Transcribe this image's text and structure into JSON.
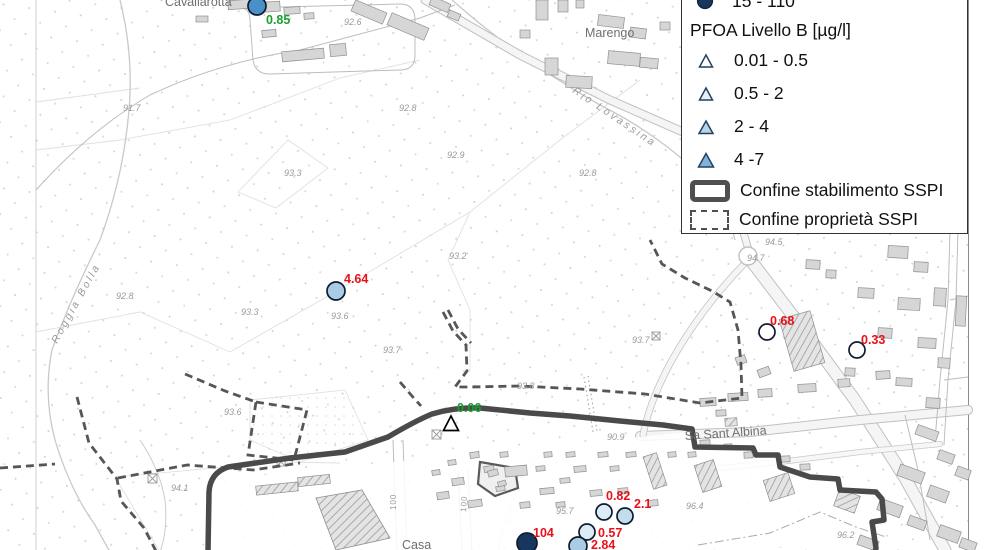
{
  "legend": {
    "cut_item": {
      "label": "15 - 110",
      "symbol": "circle",
      "color": "#17375e"
    },
    "section_title": "PFOA Livello B [µg/l]",
    "triangle_items": [
      {
        "label": "0.01 - 0.5",
        "color": "#ffffff"
      },
      {
        "label": "0.5 - 2",
        "color": "#e9f1f8"
      },
      {
        "label": "2 - 4",
        "color": "#b9d3e8"
      },
      {
        "label": "4 -7",
        "color": "#7fb3da"
      }
    ],
    "boundary_items": [
      {
        "label": "Confine stabilimento SSPI",
        "style": "solid"
      },
      {
        "label": "Confine proprietà SSPI",
        "style": "dashed"
      }
    ]
  },
  "map": {
    "points": [
      {
        "shape": "circle",
        "value": "0.85",
        "x": 257,
        "y": 6,
        "r": 9,
        "fill": "#4a90c8",
        "label_color": "#17a02e",
        "lx": 266,
        "ly": 24
      },
      {
        "shape": "circle",
        "value": "4.64",
        "x": 336,
        "y": 291,
        "r": 9,
        "fill": "#a9cbe5",
        "label_color": "#e8111a",
        "lx": 344,
        "ly": 283
      },
      {
        "shape": "circle",
        "value": "0.68",
        "x": 767,
        "y": 332,
        "r": 8,
        "fill": "#ffffff",
        "label_color": "#e8111a",
        "lx": 770,
        "ly": 325
      },
      {
        "shape": "circle",
        "value": "0.33",
        "x": 857,
        "y": 350,
        "r": 8,
        "fill": "#ffffff",
        "label_color": "#e8111a",
        "lx": 861,
        "ly": 344
      },
      {
        "shape": "circle",
        "value": "0.82",
        "x": 604,
        "y": 512,
        "r": 8,
        "fill": "#dcebf6",
        "label_color": "#e8111a",
        "lx": 606,
        "ly": 500
      },
      {
        "shape": "circle",
        "value": "2.1",
        "x": 625,
        "y": 516,
        "r": 8,
        "fill": "#c3ddee",
        "label_color": "#e8111a",
        "lx": 634,
        "ly": 508
      },
      {
        "shape": "circle",
        "value": "0.57",
        "x": 587,
        "y": 532,
        "r": 8,
        "fill": "#dcebf6",
        "label_color": "#e8111a",
        "lx": 598,
        "ly": 537
      },
      {
        "shape": "circle",
        "value": "104",
        "x": 527,
        "y": 543,
        "r": 10,
        "fill": "#17375e",
        "label_color": "#e8111a",
        "lx": 533,
        "ly": 537
      },
      {
        "shape": "circle",
        "value": "2.84",
        "x": 578,
        "y": 546,
        "r": 9,
        "fill": "#a9cbe5",
        "label_color": "#e8111a",
        "lx": 591,
        "ly": 549
      },
      {
        "shape": "triangle",
        "value": "0.06",
        "x": 451,
        "y": 424,
        "r": 8,
        "fill": "#ffffff",
        "label_color": "#17a02e",
        "lx": 457,
        "ly": 412
      }
    ],
    "place_labels": [
      {
        "text": "Cavallarotta",
        "x": 165,
        "y": 6,
        "rot": 0,
        "cls": "place"
      },
      {
        "text": "Marengo",
        "x": 585,
        "y": 37,
        "rot": 0,
        "cls": "place"
      },
      {
        "text": "Rio Lovassina",
        "x": 572,
        "y": 92,
        "rot": 34,
        "cls": "stream"
      },
      {
        "text": "Roggia Bolla",
        "x": 57,
        "y": 344,
        "rot": -61,
        "cls": "stream"
      },
      {
        "text": "Sa Sant Albina",
        "x": 685,
        "y": 440,
        "rot": -4,
        "cls": "place"
      },
      {
        "text": "Casa",
        "x": 402,
        "y": 549,
        "rot": 0,
        "cls": "place"
      },
      {
        "text": "100",
        "x": 396,
        "y": 510,
        "rot": -90,
        "cls": "roadnum"
      },
      {
        "text": "100",
        "x": 466,
        "y": 512,
        "rot": -87,
        "cls": "roadnum"
      }
    ],
    "elevation_labels": [
      {
        "text": "92.6",
        "x": 344,
        "y": 25
      },
      {
        "text": "91.7",
        "x": 123,
        "y": 111
      },
      {
        "text": "92.8",
        "x": 399,
        "y": 111
      },
      {
        "text": "92.9",
        "x": 447,
        "y": 158
      },
      {
        "text": "93.3",
        "x": 284,
        "y": 176
      },
      {
        "text": "92.8",
        "x": 579,
        "y": 176
      },
      {
        "text": "93.2",
        "x": 449,
        "y": 259
      },
      {
        "text": "92.8",
        "x": 116,
        "y": 299
      },
      {
        "text": "93.3",
        "x": 241,
        "y": 315
      },
      {
        "text": "93.6",
        "x": 331,
        "y": 319
      },
      {
        "text": "93.7",
        "x": 383,
        "y": 353
      },
      {
        "text": "93.7",
        "x": 632,
        "y": 343
      },
      {
        "text": "93.8",
        "x": 517,
        "y": 389
      },
      {
        "text": "93.6",
        "x": 224,
        "y": 415
      },
      {
        "text": "94.1",
        "x": 171,
        "y": 491
      },
      {
        "text": "94.5",
        "x": 765,
        "y": 245
      },
      {
        "text": "94.7",
        "x": 747,
        "y": 261
      },
      {
        "text": "90.9",
        "x": 607,
        "y": 440
      },
      {
        "text": "95.7",
        "x": 556,
        "y": 514
      },
      {
        "text": "96.4",
        "x": 686,
        "y": 509
      },
      {
        "text": "96.2",
        "x": 837,
        "y": 538
      }
    ]
  },
  "colors": {
    "accent_red": "#e8111a",
    "accent_green": "#17a02e",
    "boundary_gray": "#4d4d4d"
  }
}
